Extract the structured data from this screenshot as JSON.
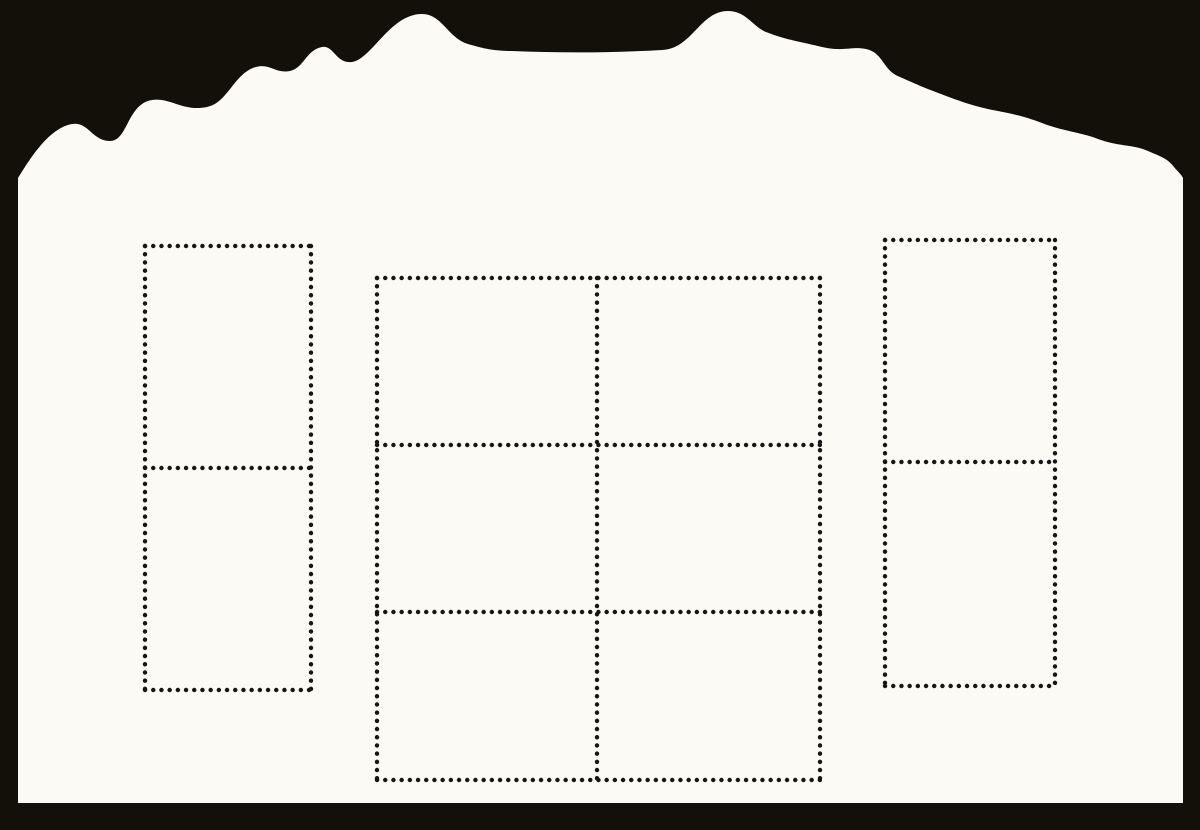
{
  "scene": {
    "description": "Scan of a blank souvenir stamp sheet with a wavy die-cut top edge on a black background",
    "object_type": "souvenir-stamp-sheet",
    "visible_text": "",
    "stamp_count_total": 10
  },
  "colors": {
    "background": "#121009",
    "paper": "#fbfaf5",
    "perforation_dot": "#161616"
  },
  "sheet": {
    "left_edge_x": 18,
    "right_edge_x": 1183,
    "bottom_edge_y": 803,
    "top_edge_style": "irregular-wavy-die-cut",
    "perforation": {
      "dot_diameter": 4.4,
      "dot_pitch": 8.1
    },
    "blocks": [
      {
        "id": "left-stamp-pair",
        "rows": 2,
        "cols": 1,
        "stamps": 2,
        "x": 145,
        "y": 246,
        "width": 166,
        "height": 444,
        "row_dividers": [
          468
        ],
        "col_dividers": []
      },
      {
        "id": "center-stamp-grid",
        "rows": 3,
        "cols": 2,
        "stamps": 6,
        "x": 377,
        "y": 278,
        "width": 443,
        "height": 502,
        "row_dividers": [
          445,
          612
        ],
        "col_dividers": [
          597
        ]
      },
      {
        "id": "right-stamp-pair",
        "rows": 2,
        "cols": 1,
        "stamps": 2,
        "x": 885,
        "y": 240,
        "width": 170,
        "height": 446,
        "row_dividers": [
          462
        ],
        "col_dividers": []
      }
    ]
  }
}
